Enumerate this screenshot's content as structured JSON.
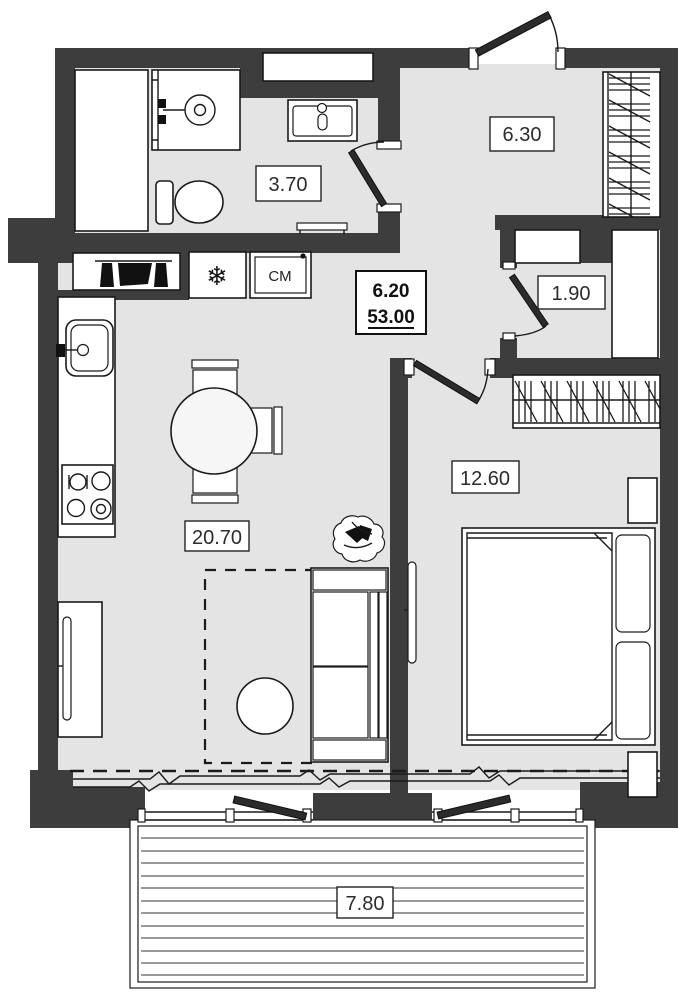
{
  "floorplan": {
    "colors": {
      "wall": "#3d3d3d",
      "floor": "#e4e4e4",
      "line": "#1a1a1a",
      "paper": "#ffffff"
    },
    "rooms": [
      {
        "id": "hallway",
        "area": "6.30"
      },
      {
        "id": "bathroom",
        "area": "3.70"
      },
      {
        "id": "closet",
        "area": "1.90"
      },
      {
        "id": "bedroom",
        "area": "12.60"
      },
      {
        "id": "living-kitchen",
        "area": "20.70"
      },
      {
        "id": "balcony",
        "area": "7.80"
      }
    ],
    "summary": {
      "floor_area": "6.20",
      "total_area": "53.00"
    },
    "appliances": {
      "washer_label": "СМ",
      "fridge_icon": "❄"
    }
  }
}
